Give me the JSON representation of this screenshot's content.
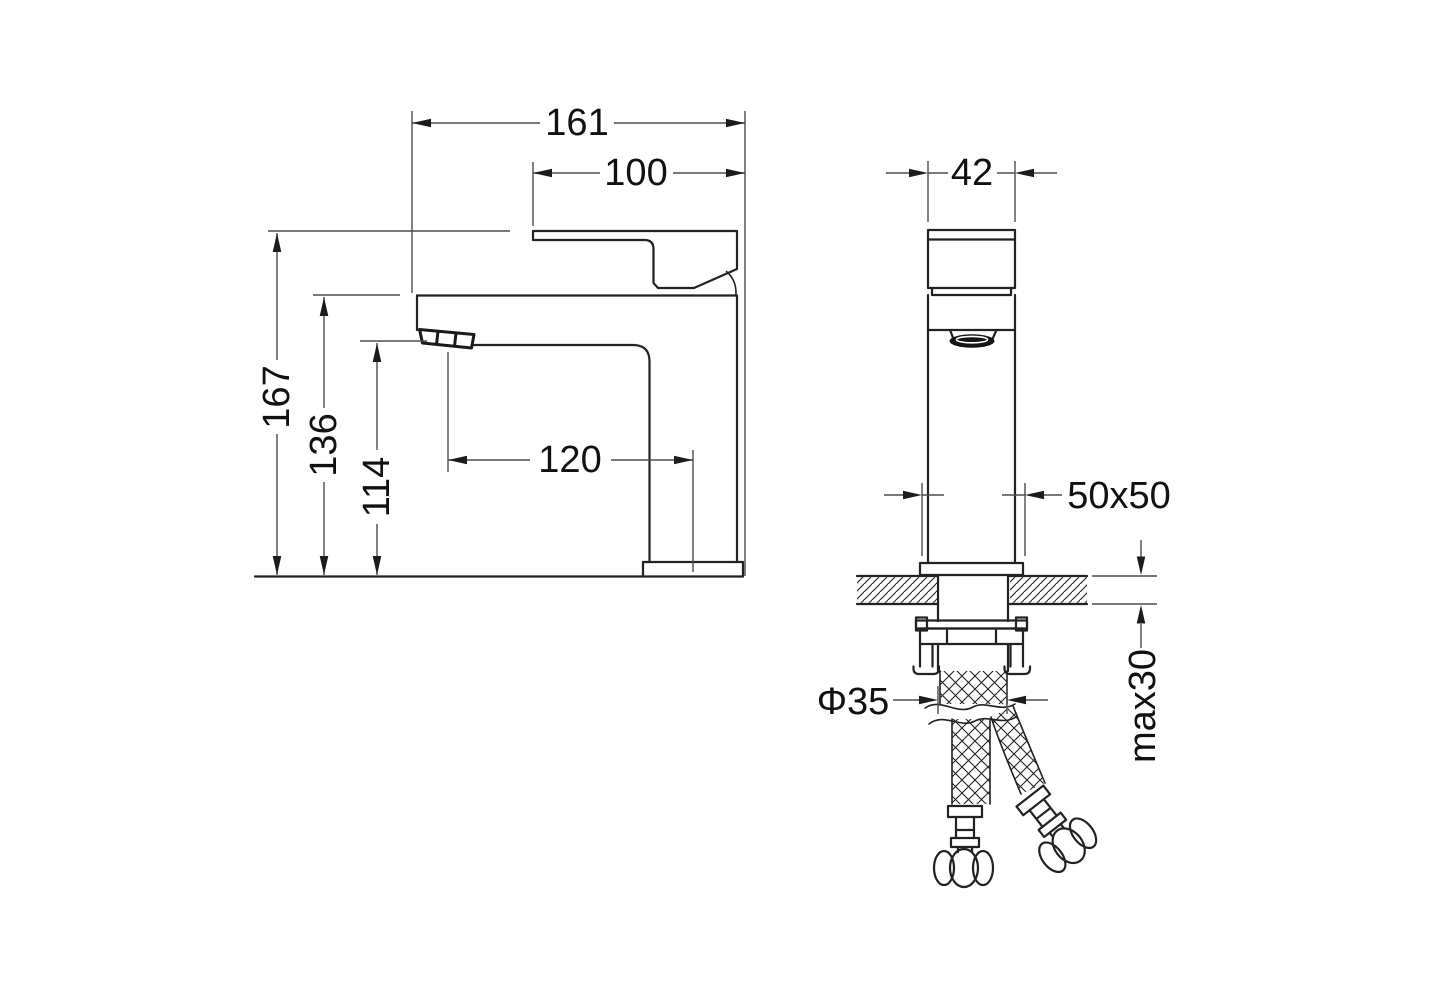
{
  "dims": {
    "overall_width": "161",
    "handle_width": "100",
    "total_height": "167",
    "spout_top_height": "136",
    "outlet_height": "114",
    "spout_reach": "120",
    "body_width": "42",
    "base_footprint": "50x50",
    "shank_diameter": "Φ35",
    "max_counter_thickness": "max30"
  },
  "colors": {
    "object_line": "#222222",
    "dimension_line": "#4d4d4d",
    "text": "#111111",
    "background": "#ffffff",
    "aerator_fill": "#151515",
    "hatch": "#333333"
  }
}
